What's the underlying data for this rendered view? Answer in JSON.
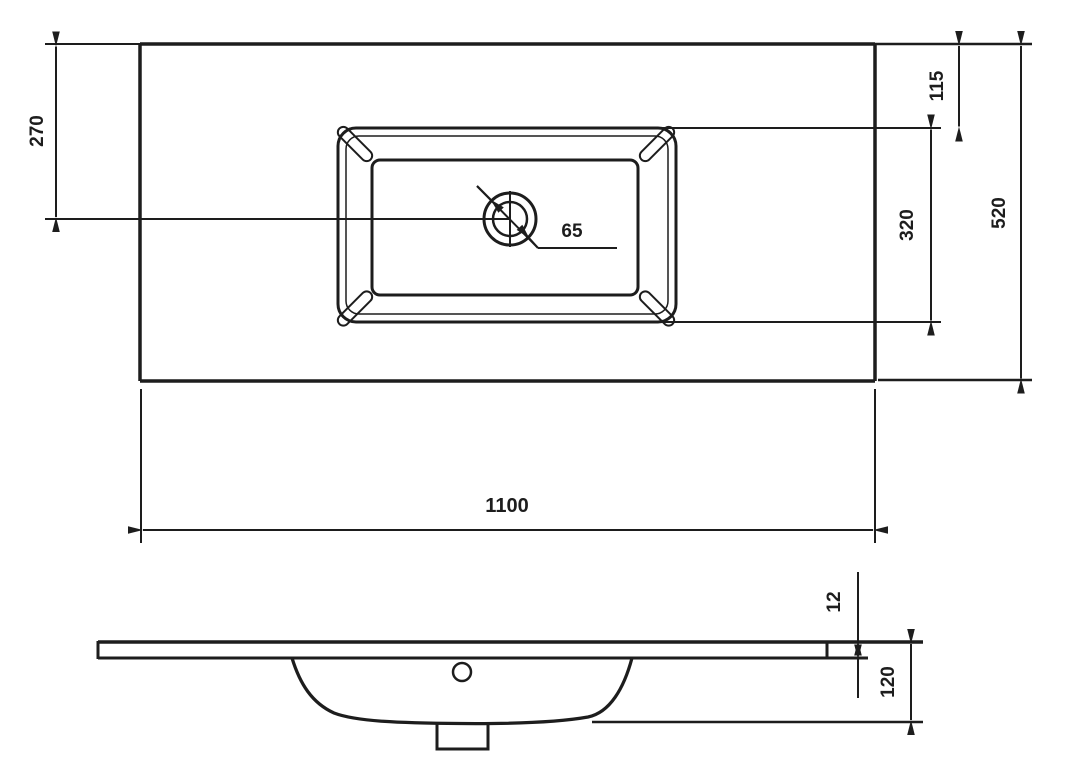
{
  "drawing": {
    "type": "technical-dimension-drawing",
    "subject": "vanity washbasin countertop, top view and side section view",
    "colors": {
      "line": "#1d1d1d",
      "background": "#ffffff"
    },
    "dimensions": {
      "top_view": {
        "hole_center_from_top": "270",
        "basin_to_top_edge": "115",
        "basin_depth": "320",
        "countertop_depth": "520",
        "hole_diameter": "65",
        "countertop_width": "1100"
      },
      "side_view": {
        "rim_thickness": "12",
        "basin_depth": "120"
      }
    }
  }
}
